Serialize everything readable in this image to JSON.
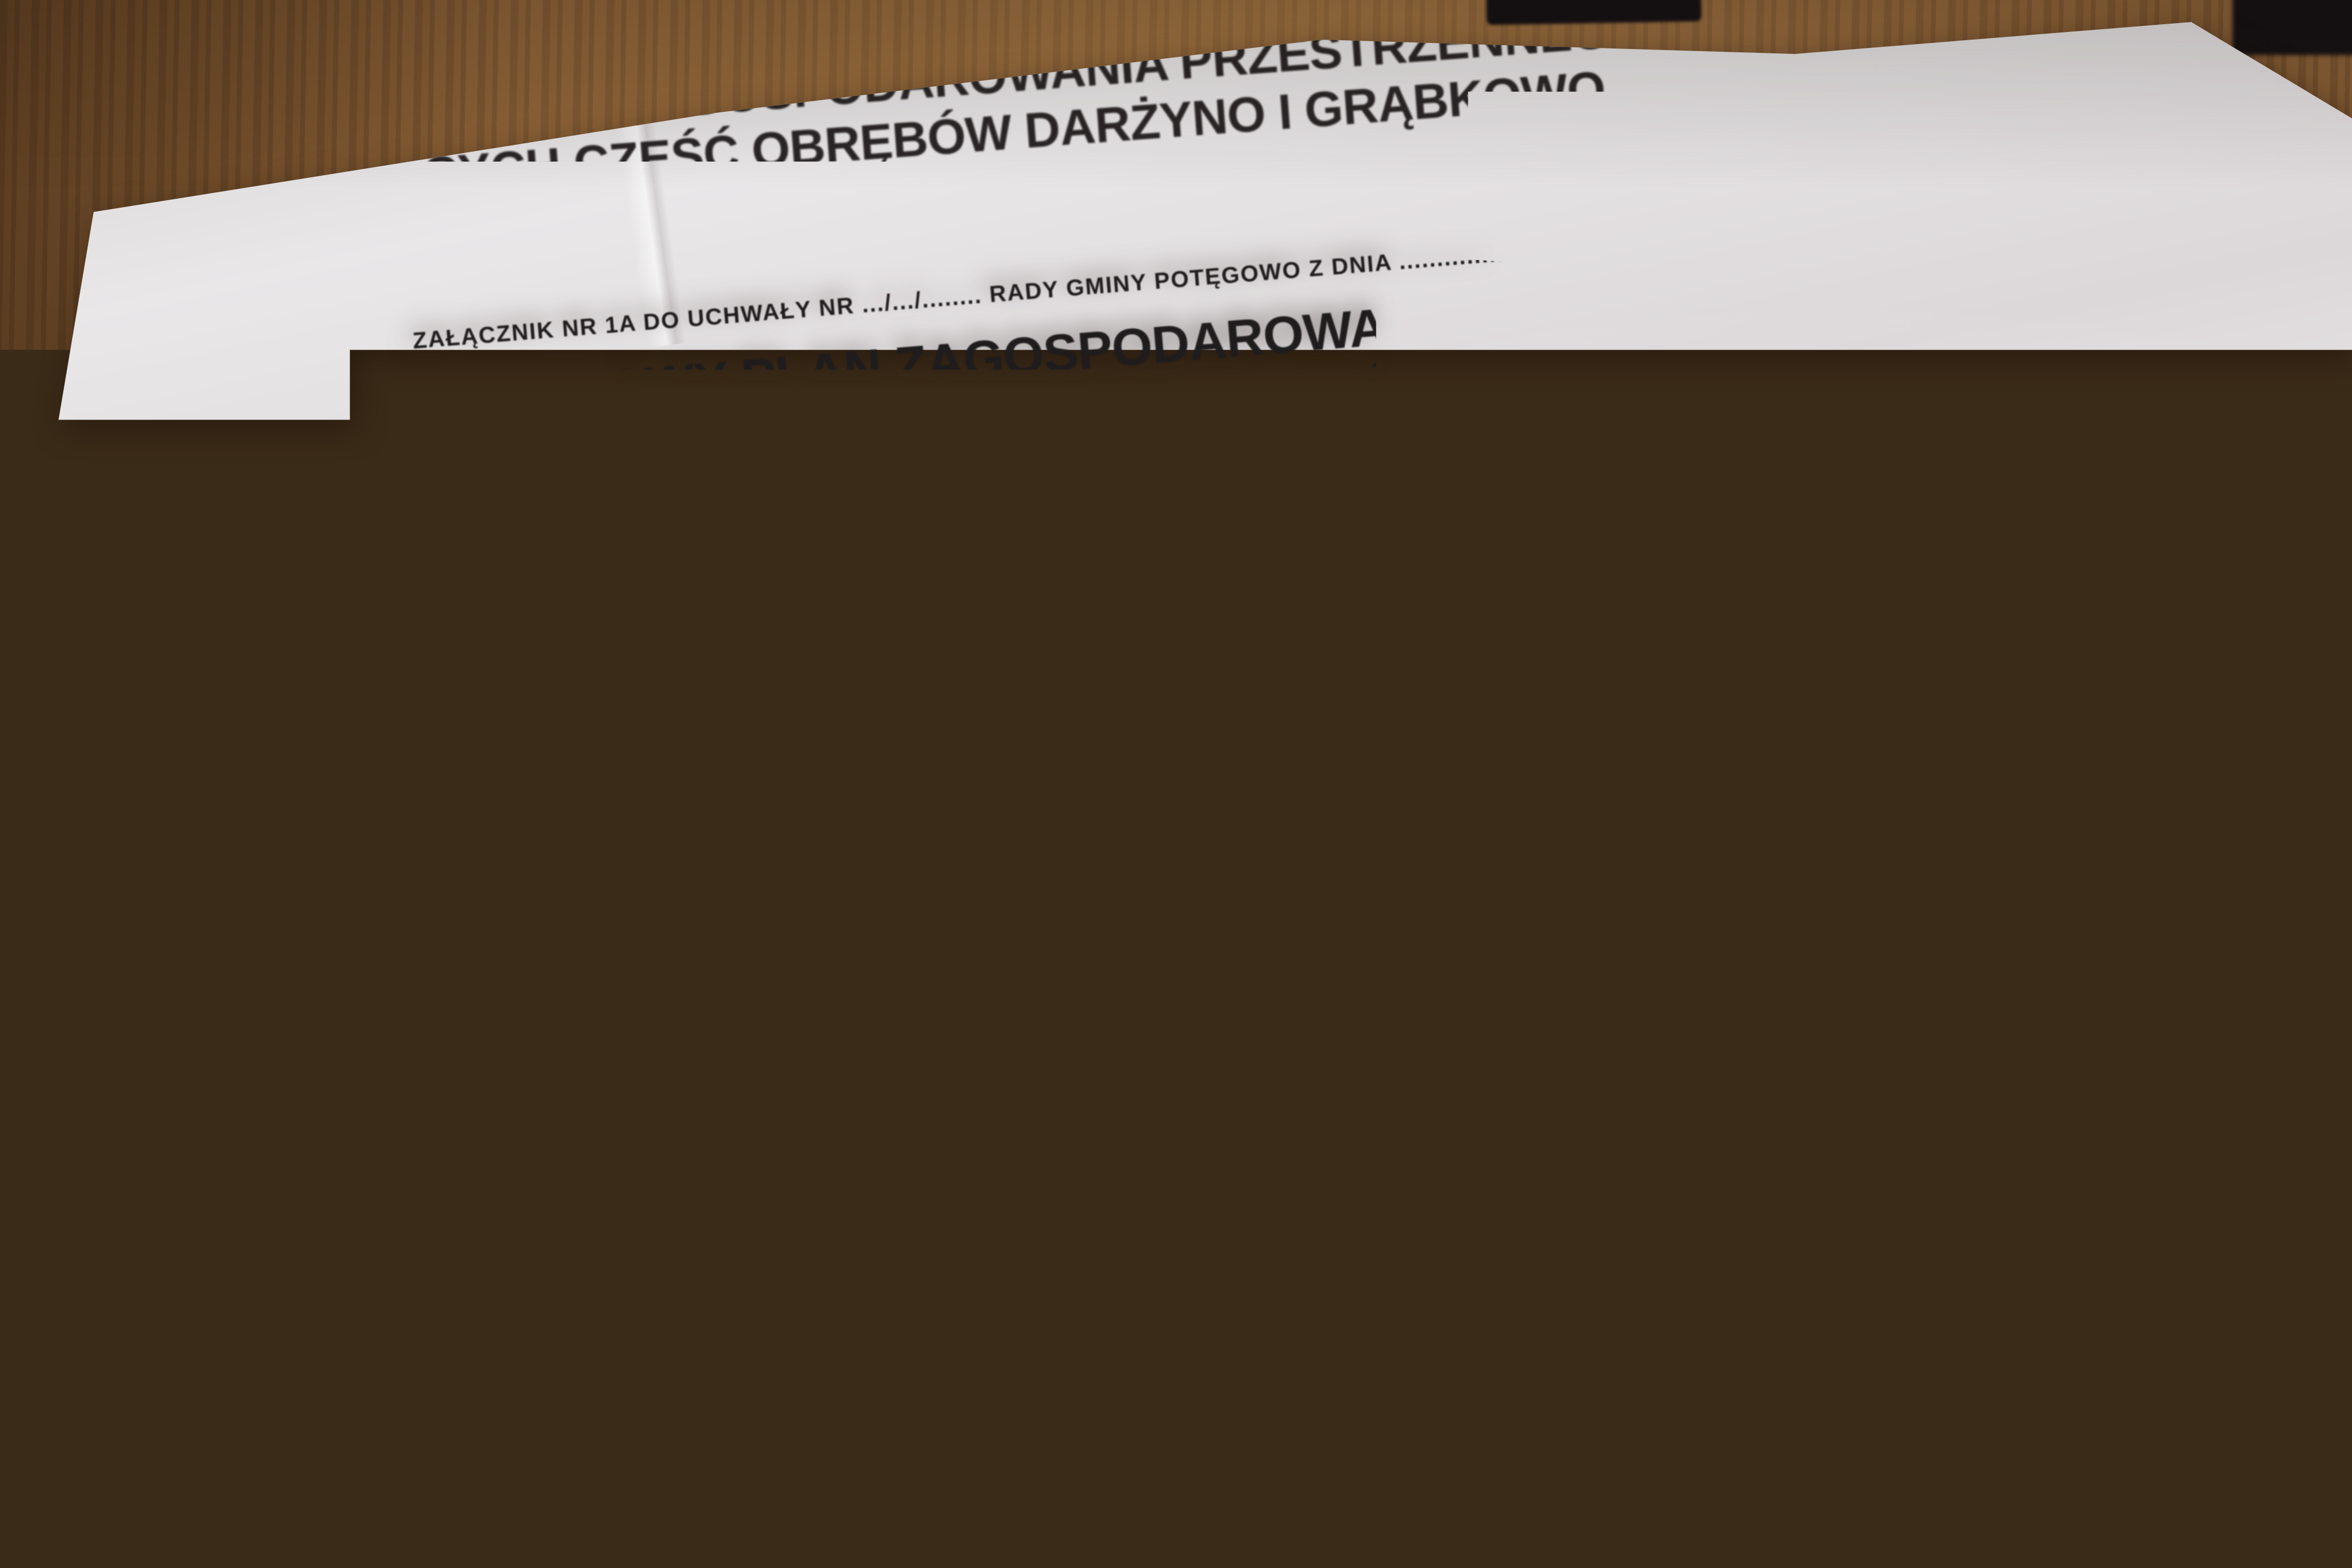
{
  "colors": {
    "wood": "#7a5430",
    "wood_dark": "#5d3f24",
    "paper": "#e9e7e8",
    "ink": "#1f1c1d",
    "ink_soft": "#3a3437"
  },
  "sheet_1b": {
    "attachment_line": "ZAŁĄCZNIK NR 1B DO UCHWAŁY NR .../.../........  RADY GMINY POTĘGOWO Z DNIA .................... R.",
    "title_lines": [
      "MIEJSCOWY PLAN ZAGOSPODAROWANIA PRZESTRZENNEGO DLA TER",
      "OBEJMUJĄCYCH CZĘŚĆ OBRĘBÓW DARŻYNO I GRĄBKOWO",
      "W GMINIE POTĘGOWO - ARKUSZ 2"
    ],
    "projekt_label": "PROJEKT",
    "legend_title": "LEGENDA",
    "codes": [
      "MN",
      "R",
      "RM",
      "ZP",
      "KD",
      "KDW",
      "E",
      "W"
    ],
    "column": [
      "USTALENIA:",
      "LINIE ROZGRANICZAJĄCE TER",
      "ZASADACH ZAGOSPODAROWA",
      "Granice terenów elementarnych",
      "OZNACZENIA TERENÓW ELEM",
      "Symbol adresowy terenu elementa",
      "Klasa drogi/ulicy - dla terenów ele",
      "Symbol rodzaju przeznaczenia ter",
      "Kolejny numer terenu elementarn",
      "Tereny zabudowy mieszkaniowej j",
      "Tereny rolne",
      "Tereny zabudowy zagrodowej w g",
      "Tereny zieleni urządzonej",
      "Tereny pasów drogowych dróg/uli",
      "Tereny dróg/ulic wewnętrznych",
      "Tereny obiektów budowlanych i u",
      "Tereny obiektów budowlanych i u",
      "ZASADY KSZTAŁTKOWANIA ZABU",
      "ZAGOSPODAROWANIA TERENU",
      "Nieprzekraczalne linie zabudowy",
      "Nieprzekraczalne linie zabudowy d",
      "ADY OCHRONY DZIEDZICTWA",
      "Granice stref częściowej ochrony a",
      "Granice stref ograniczonej ochrony",
      "KOMUNIKACYJNY I OBSŁU",
      "eny pasów drogowych dróg/ulic",
      "ulic określająca wymagania tech",
      "a",
      "a",
      "dróg/ulic wewnętrznych",
      "ia systemu komunikacyjneg",
      "ym",
      "OWANIE TYMCZASOW",
      "tórych ustalono zagospo",
      "objętego planem",
      "ologiczne wpisane do",
      "z obszar planu napo",
      "obszar planu napo",
      "napowietrznych li",
      "m;  dla linii 0,4 k"
    ]
  },
  "sheet_1a": {
    "attachment_line": "ZAŁĄCZNIK NR 1A DO UCHWAŁY NR .../.../........  RADY GMINY POTĘGOWO Z DNIA .....................",
    "title_lines": [
      "MIEJSCOWY PLAN ZAGOSPODAROWANIA PRZESTRZENN",
      "DLA TERENÓW OBEJMUJĄCYCH CZĘŚĆ OBRĘBÓW",
      "DARŻYNO I GRĄBKOWO W GMINIE POTĘGOWO - ARKUS"
    ],
    "projekt_label": "PROJEKT",
    "legend": {
      "title": "LEGENDA",
      "ustalenia_header": "USTALENIA:",
      "linie_line1": "LINIE ROZGRANICZAJĄCE TERENY O RÓŻNYM PRZEZNACZENIU LUB RÓŻNYCH",
      "linie_line2": "ZASADACH ZAGOSPODAROWANIA",
      "granice_label": "Granice terenów elementarnych",
      "oznaczenia_header": "OZNACZENIA TERENÓW ELEMENTARNYCH",
      "addr_code": "X.A-B",
      "addr_line1": "Symbol adresowy terenu elementarnego",
      "addr_line2": "Klasa drogi/ulicy - dla terenów elementarnych przeznaczonych pod drogi/ulice publiczne",
      "addr_line3": "Symbol rodzaju przeznaczenia terenu",
      "addr_line4": "Kolejny numer terenu elementarnego",
      "przeznaczenie_header": "PRZEZNACZENIE TERENU",
      "rows": [
        {
          "code": "MN",
          "label": "Tereny zabudowy mieszkaniowej jednorodzinnej"
        },
        {
          "code": "R",
          "label": "Tereny rolne"
        },
        {
          "code": "RM",
          "label": "Tereny zabudowy zagrodowej w gospodarstwach rolnych, hodowlanych i ogrodniczych"
        },
        {
          "code": "ZP",
          "label": "Tereny zieleni urządzonej"
        },
        {
          "code": "KD",
          "label": "Tereny pasów drogowych dróg/ulic publicznych"
        },
        {
          "code": "KDW",
          "label": "Tereny dróg/ulic wewnętrznych"
        },
        {
          "code": "E",
          "label": "Tereny obiektów budowlanych i urządzeń elektroenergetycznej infrastruktury technicznej"
        },
        {
          "code": "W",
          "label": "Tereny obiektów budowlanych i urządzeń wodociągowej infrastruktury technicznej"
        }
      ],
      "zasady_line1": "ZASADY KSZTAŁTKOWANIA ZABUDOWY ORAZ WSKAŹNIKI",
      "zasady_line2": "ZAGOSPODAROWANIA TERENU",
      "niep_line1": "Nieprzekraczalne linie zabudowy",
      "niep_line2": "Nieprzekraczalne linie zabudowy dla budynków mieszkalnych"
    },
    "middle": {
      "ochrona_header": "ZASADY OCHRONY DZIEDZICTWA KULTUROWEGO I ZABYTKÓW",
      "w2_label": "Granice stref częściowej ochrony archeologicznej W.2",
      "w3_label": "Granice stref ograniczonej ochrony archeologicznej W.3",
      "system_header": "SYSTEM KOMUNIKACYJNY I OBSŁUGA KOMUNIKACYJNA",
      "kd_code": "KD",
      "kd_label": "Tereny pasów drogowych dróg/ulic publicznych",
      "klasa_line": "Klasa dróg/ulic określająca wymagania techniczne i użytkowe:",
      "l_code": "L",
      "l_label": "Lokalna",
      "z_code": "Z",
      "z_label": "Zbiorcza",
      "kdw_code": "KDW",
      "kdw_label": "Tereny dróg/ulic wewnętrznych",
      "powiazania_line1": "Powiązania systemu komunikacyjnego obsługującego obszar objęty planem",
      "powiazania_line2": "z układem zewnętrznym",
      "tymczasowe_header": "ZAGOSPODAROWANIE TYMCZASOWE I INNE USTALENIA STANOWIĄCE",
      "tymczasowe_label": "Tereny dla których ustalono zagospodarowanie tymczasowe"
    },
    "informacje": {
      "header": "INFORMACJE:",
      "items": [
        "Granice obszaru objętego planem",
        "Stanowiska archeologiczne wpisane do Wojewódzkiej Ewidenc",
        "Przebiegające przez obszar planu napowietrzne linie elektroe",
        "Przebiegające przez obszar planu napowietrzne linie elektroe",
        "Strefy techniczne od napowietrznych linii elektroenergetycz",
        "dla linii 15 kv - 2 x 7,5 m;  dla linii 0,4 kV - 2 x 3 m"
      ]
    },
    "map": {
      "labels": [
        "22.MN",
        "21.R",
        "20.ZP",
        "19.R",
        "21.R",
        "2.KDW"
      ]
    }
  },
  "sheet_small": {
    "header": "NA POTĘGOWO",
    "footer_lines": [
      "PODAROWANIA PRZESTRZENNEGO",
      "CZĘŚĆ OBRĘBU DARŻYNO",
      "OWO"
    ]
  }
}
